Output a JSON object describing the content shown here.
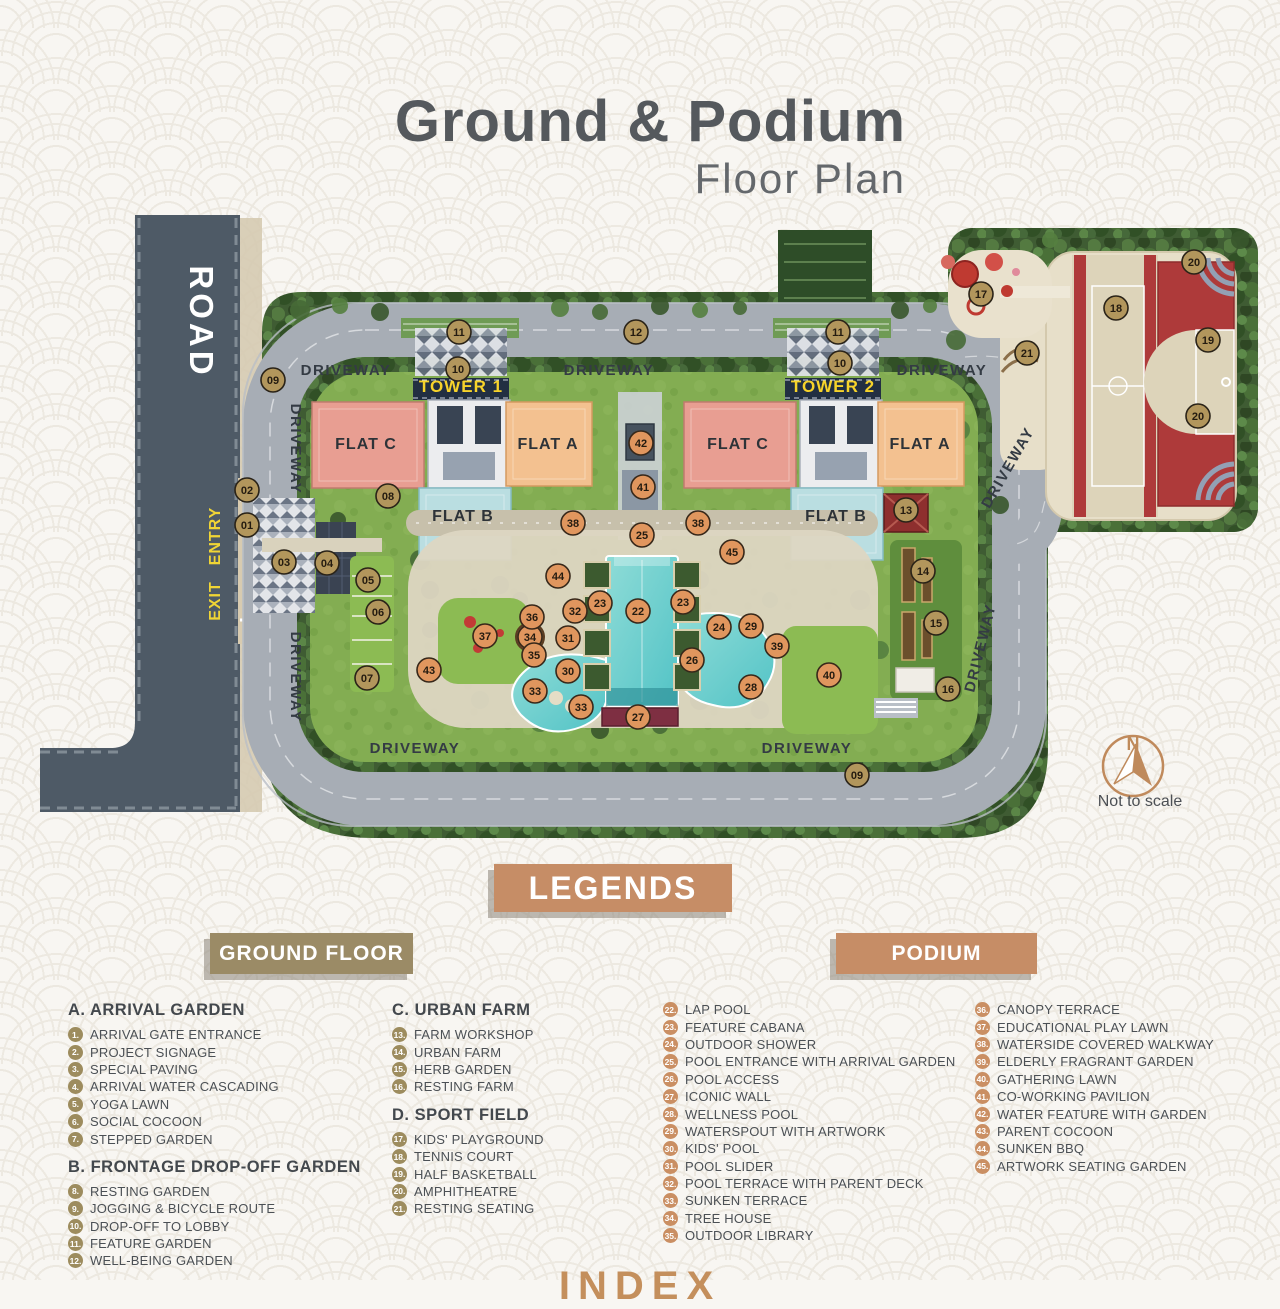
{
  "title": {
    "main": "Ground & Podium",
    "sub": "Floor Plan"
  },
  "plan": {
    "labels": [
      {
        "text": "ROAD",
        "x": 190,
        "y": 322,
        "rot": 90,
        "kind": "road"
      },
      {
        "text": "ENTRY",
        "x": 220,
        "y": 536,
        "rot": -90,
        "kind": "gate"
      },
      {
        "text": "EXIT",
        "x": 220,
        "y": 601,
        "rot": -90,
        "kind": "gate"
      },
      {
        "text": "DRIVEWAY",
        "x": 346,
        "y": 375,
        "rot": 0,
        "kind": "drive"
      },
      {
        "text": "DRIVEWAY",
        "x": 609,
        "y": 375,
        "rot": 0,
        "kind": "drive"
      },
      {
        "text": "DRIVEWAY",
        "x": 942,
        "y": 375,
        "rot": 0,
        "kind": "drive"
      },
      {
        "text": "DRIVEWAY",
        "x": 291,
        "y": 449,
        "rot": 90,
        "kind": "drive"
      },
      {
        "text": "DRIVEWAY",
        "x": 291,
        "y": 677,
        "rot": 90,
        "kind": "drive"
      },
      {
        "text": "DRIVEWAY",
        "x": 415,
        "y": 753,
        "rot": 0,
        "kind": "drive"
      },
      {
        "text": "DRIVEWAY",
        "x": 807,
        "y": 753,
        "rot": 0,
        "kind": "drive"
      },
      {
        "text": "DRIVEWAY",
        "x": 1012,
        "y": 470,
        "rot": -60,
        "kind": "drive"
      },
      {
        "text": "DRIVEWAY",
        "x": 985,
        "y": 649,
        "rot": -76,
        "kind": "drive"
      },
      {
        "text": "TOWER 1",
        "x": 461,
        "y": 392,
        "rot": 0,
        "kind": "tower"
      },
      {
        "text": "TOWER 2",
        "x": 833,
        "y": 392,
        "rot": 0,
        "kind": "tower"
      },
      {
        "text": "FLAT C",
        "x": 366,
        "y": 449,
        "rot": 0,
        "kind": "flat"
      },
      {
        "text": "FLAT A",
        "x": 548,
        "y": 449,
        "rot": 0,
        "kind": "flat"
      },
      {
        "text": "FLAT B",
        "x": 463,
        "y": 521,
        "rot": 0,
        "kind": "flat"
      },
      {
        "text": "FLAT C",
        "x": 738,
        "y": 449,
        "rot": 0,
        "kind": "flat"
      },
      {
        "text": "FLAT A",
        "x": 920,
        "y": 449,
        "rot": 0,
        "kind": "flat"
      },
      {
        "text": "FLAT B",
        "x": 836,
        "y": 521,
        "rot": 0,
        "kind": "flat"
      },
      {
        "text": "N",
        "x": 1133,
        "y": 750,
        "rot": 0,
        "kind": "north"
      },
      {
        "text": "Not to scale",
        "x": 1140,
        "y": 806,
        "rot": 0,
        "kind": "scale"
      }
    ],
    "markers": [
      {
        "n": "01",
        "x": 247,
        "y": 525,
        "t": "g"
      },
      {
        "n": "02",
        "x": 247,
        "y": 490,
        "t": "g"
      },
      {
        "n": "03",
        "x": 284,
        "y": 562,
        "t": "g"
      },
      {
        "n": "04",
        "x": 327,
        "y": 563,
        "t": "g"
      },
      {
        "n": "05",
        "x": 368,
        "y": 580,
        "t": "g"
      },
      {
        "n": "06",
        "x": 378,
        "y": 612,
        "t": "g"
      },
      {
        "n": "07",
        "x": 367,
        "y": 678,
        "t": "g"
      },
      {
        "n": "08",
        "x": 388,
        "y": 496,
        "t": "g"
      },
      {
        "n": "09",
        "x": 273,
        "y": 380,
        "t": "g"
      },
      {
        "n": "09",
        "x": 857,
        "y": 775,
        "t": "g"
      },
      {
        "n": "10",
        "x": 458,
        "y": 369,
        "t": "g"
      },
      {
        "n": "10",
        "x": 840,
        "y": 363,
        "t": "g"
      },
      {
        "n": "11",
        "x": 459,
        "y": 332,
        "t": "g"
      },
      {
        "n": "11",
        "x": 838,
        "y": 332,
        "t": "g"
      },
      {
        "n": "12",
        "x": 636,
        "y": 332,
        "t": "g"
      },
      {
        "n": "13",
        "x": 906,
        "y": 510,
        "t": "g"
      },
      {
        "n": "14",
        "x": 923,
        "y": 571,
        "t": "g"
      },
      {
        "n": "15",
        "x": 936,
        "y": 623,
        "t": "g"
      },
      {
        "n": "16",
        "x": 948,
        "y": 689,
        "t": "g"
      },
      {
        "n": "17",
        "x": 981,
        "y": 294,
        "t": "g"
      },
      {
        "n": "18",
        "x": 1116,
        "y": 308,
        "t": "g"
      },
      {
        "n": "19",
        "x": 1208,
        "y": 340,
        "t": "g"
      },
      {
        "n": "20",
        "x": 1194,
        "y": 262,
        "t": "g"
      },
      {
        "n": "20",
        "x": 1198,
        "y": 416,
        "t": "g"
      },
      {
        "n": "21",
        "x": 1027,
        "y": 353,
        "t": "g"
      },
      {
        "n": "22",
        "x": 638,
        "y": 611,
        "t": "p"
      },
      {
        "n": "23",
        "x": 600,
        "y": 603,
        "t": "p"
      },
      {
        "n": "23",
        "x": 683,
        "y": 602,
        "t": "p"
      },
      {
        "n": "24",
        "x": 719,
        "y": 627,
        "t": "p"
      },
      {
        "n": "25",
        "x": 642,
        "y": 535,
        "t": "p"
      },
      {
        "n": "26",
        "x": 692,
        "y": 660,
        "t": "p"
      },
      {
        "n": "27",
        "x": 638,
        "y": 717,
        "t": "p"
      },
      {
        "n": "28",
        "x": 751,
        "y": 687,
        "t": "p"
      },
      {
        "n": "29",
        "x": 751,
        "y": 626,
        "t": "p"
      },
      {
        "n": "30",
        "x": 568,
        "y": 671,
        "t": "p"
      },
      {
        "n": "31",
        "x": 568,
        "y": 638,
        "t": "p"
      },
      {
        "n": "32",
        "x": 575,
        "y": 611,
        "t": "p"
      },
      {
        "n": "33",
        "x": 535,
        "y": 691,
        "t": "p"
      },
      {
        "n": "33",
        "x": 581,
        "y": 707,
        "t": "p"
      },
      {
        "n": "34",
        "x": 530,
        "y": 637,
        "t": "p"
      },
      {
        "n": "35",
        "x": 534,
        "y": 655,
        "t": "p"
      },
      {
        "n": "36",
        "x": 532,
        "y": 617,
        "t": "p"
      },
      {
        "n": "37",
        "x": 485,
        "y": 636,
        "t": "p"
      },
      {
        "n": "38",
        "x": 573,
        "y": 523,
        "t": "p"
      },
      {
        "n": "38",
        "x": 698,
        "y": 523,
        "t": "p"
      },
      {
        "n": "39",
        "x": 777,
        "y": 646,
        "t": "p"
      },
      {
        "n": "40",
        "x": 829,
        "y": 675,
        "t": "p"
      },
      {
        "n": "41",
        "x": 643,
        "y": 487,
        "t": "p"
      },
      {
        "n": "42",
        "x": 641,
        "y": 443,
        "t": "p"
      },
      {
        "n": "43",
        "x": 429,
        "y": 670,
        "t": "p"
      },
      {
        "n": "44",
        "x": 558,
        "y": 576,
        "t": "p"
      },
      {
        "n": "45",
        "x": 732,
        "y": 552,
        "t": "p"
      }
    ]
  },
  "legends": {
    "header": "LEGENDS",
    "ground": {
      "label": "GROUND FLOOR",
      "sections": [
        {
          "heading": "A. ARRIVAL GARDEN",
          "items": [
            {
              "n": "1",
              "label": "ARRIVAL GATE ENTRANCE"
            },
            {
              "n": "2",
              "label": "PROJECT SIGNAGE"
            },
            {
              "n": "3",
              "label": "SPECIAL PAVING"
            },
            {
              "n": "4",
              "label": "ARRIVAL WATER CASCADING"
            },
            {
              "n": "5",
              "label": "YOGA LAWN"
            },
            {
              "n": "6",
              "label": "SOCIAL COCOON"
            },
            {
              "n": "7",
              "label": "STEPPED GARDEN"
            }
          ]
        },
        {
          "heading": "B. FRONTAGE DROP-OFF GARDEN",
          "items": [
            {
              "n": "8",
              "label": "RESTING GARDEN"
            },
            {
              "n": "9",
              "label": "JOGGING & BICYCLE ROUTE"
            },
            {
              "n": "10",
              "label": "DROP-OFF TO LOBBY"
            },
            {
              "n": "11",
              "label": "FEATURE GARDEN"
            },
            {
              "n": "12",
              "label": "WELL-BEING GARDEN"
            }
          ]
        },
        {
          "heading": "C. URBAN FARM",
          "items": [
            {
              "n": "13",
              "label": "FARM WORKSHOP"
            },
            {
              "n": "14",
              "label": "URBAN FARM"
            },
            {
              "n": "15",
              "label": "HERB GARDEN"
            },
            {
              "n": "16",
              "label": "RESTING FARM"
            }
          ]
        },
        {
          "heading": "D. SPORT FIELD",
          "items": [
            {
              "n": "17",
              "label": "KIDS' PLAYGROUND"
            },
            {
              "n": "18",
              "label": "TENNIS COURT"
            },
            {
              "n": "19",
              "label": "HALF BASKETBALL"
            },
            {
              "n": "20",
              "label": "AMPHITHEATRE"
            },
            {
              "n": "21",
              "label": "RESTING SEATING"
            }
          ]
        }
      ]
    },
    "podium": {
      "label": "PODIUM",
      "items": [
        {
          "n": "22",
          "label": "LAP POOL"
        },
        {
          "n": "23",
          "label": "FEATURE CABANA"
        },
        {
          "n": "24",
          "label": "OUTDOOR SHOWER"
        },
        {
          "n": "25",
          "label": "POOL ENTRANCE WITH ARRIVAL GARDEN"
        },
        {
          "n": "26",
          "label": "POOL ACCESS"
        },
        {
          "n": "27",
          "label": "ICONIC WALL"
        },
        {
          "n": "28",
          "label": "WELLNESS POOL"
        },
        {
          "n": "29",
          "label": "WATERSPOUT WITH ARTWORK"
        },
        {
          "n": "30",
          "label": "KIDS' POOL"
        },
        {
          "n": "31",
          "label": "POOL SLIDER"
        },
        {
          "n": "32",
          "label": "POOL TERRACE WITH PARENT DECK"
        },
        {
          "n": "33",
          "label": "SUNKEN TERRACE"
        },
        {
          "n": "34",
          "label": "TREE HOUSE"
        },
        {
          "n": "35",
          "label": "OUTDOOR LIBRARY"
        },
        {
          "n": "36",
          "label": "CANOPY TERRACE"
        },
        {
          "n": "37",
          "label": "EDUCATIONAL PLAY LAWN"
        },
        {
          "n": "38",
          "label": "WATERSIDE COVERED WALKWAY"
        },
        {
          "n": "39",
          "label": "ELDERLY FRAGRANT GARDEN"
        },
        {
          "n": "40",
          "label": "GATHERING LAWN"
        },
        {
          "n": "41",
          "label": "CO-WORKING PAVILION"
        },
        {
          "n": "42",
          "label": "WATER FEATURE WITH GARDEN"
        },
        {
          "n": "43",
          "label": "PARENT COCOON"
        },
        {
          "n": "44",
          "label": "SUNKEN BBQ"
        },
        {
          "n": "45",
          "label": "ARTWORK SEATING GARDEN"
        }
      ]
    }
  },
  "footer": {
    "index_partial": "INDEX"
  }
}
